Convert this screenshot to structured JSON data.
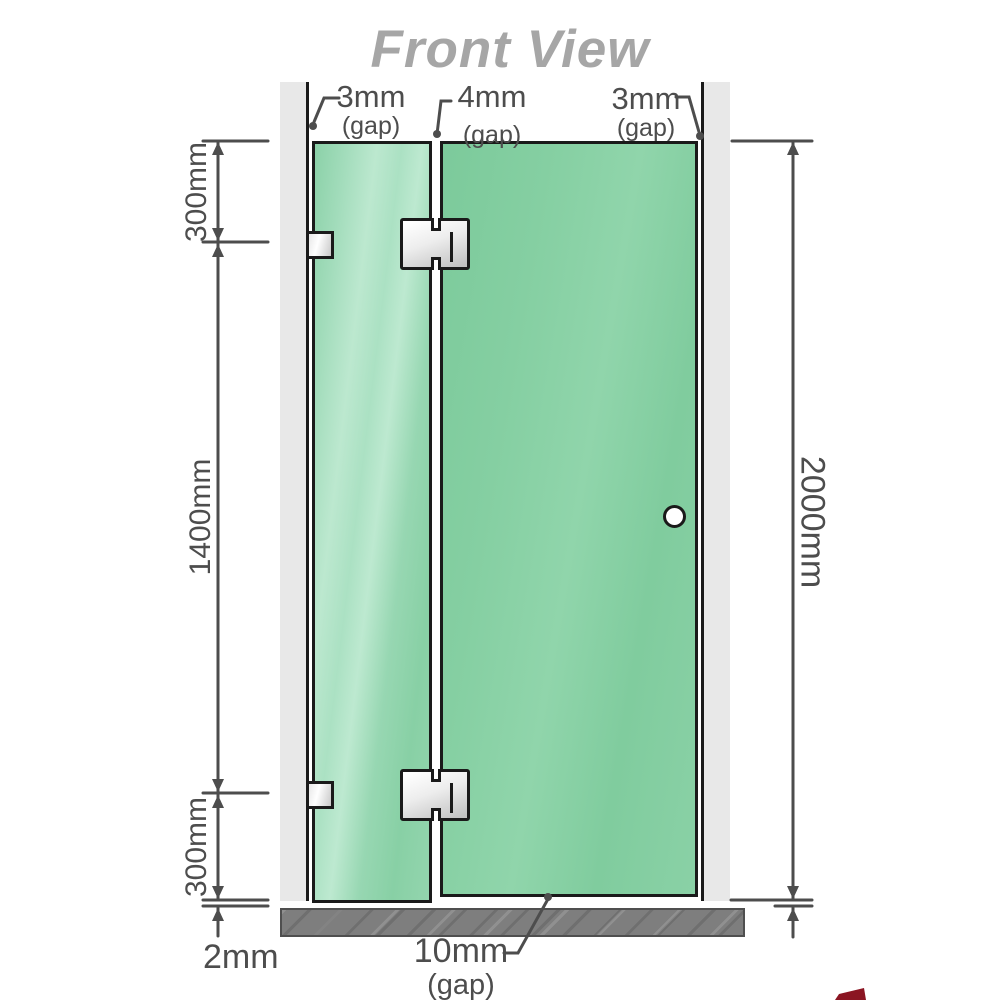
{
  "title": "Front View",
  "annotations": {
    "gap_top_left": {
      "value": "3mm",
      "suffix": "(gap)"
    },
    "gap_top_middle": {
      "value": "4mm",
      "suffix": "(gap)"
    },
    "gap_top_right": {
      "value": "3mm",
      "suffix": "(gap)"
    },
    "gap_bottom_door": {
      "value": "10mm",
      "suffix": "(gap)"
    },
    "left_top": "300mm",
    "left_middle": "1400mm",
    "left_bottom": "300mm",
    "left_floor_gap": "2mm",
    "right_total": "2000mm"
  },
  "colors": {
    "glass_green": "#8ed3ab",
    "door_green": "#7ecb9e",
    "wall_gray": "#e8e8e8",
    "floor_gray": "#7e7e7e",
    "outline_black": "#1a1a1a",
    "dimension_gray": "#4d4d4d",
    "title_gray": "#a6a6a6",
    "logo_red": "#8b1522"
  }
}
